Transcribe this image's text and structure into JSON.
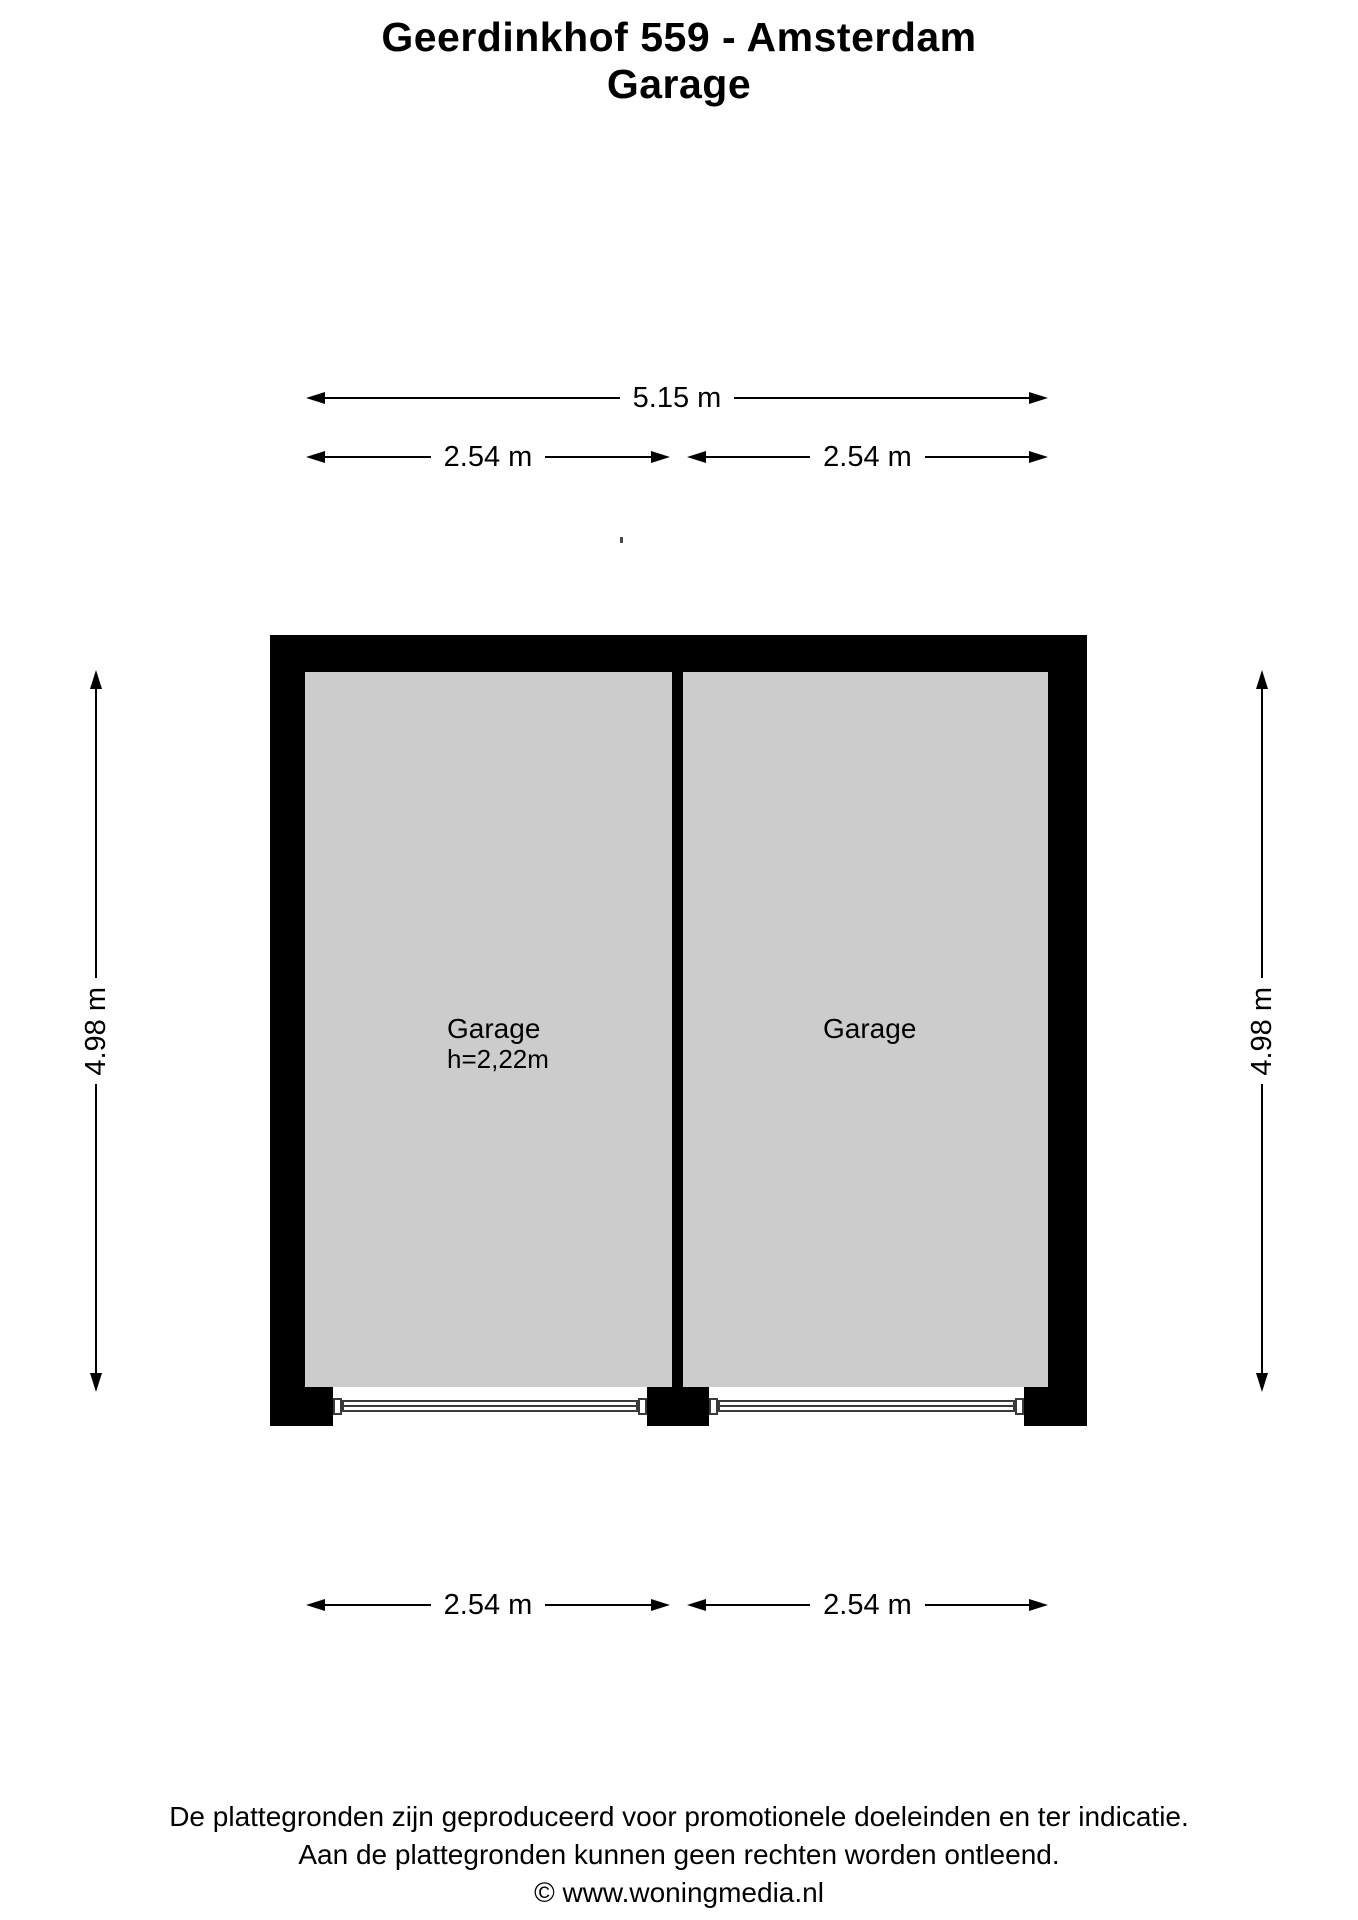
{
  "title": {
    "line1": "Geerdinkhof 559 - Amsterdam",
    "line2": "Garage"
  },
  "dimensions": {
    "top_total": {
      "label": "5.15 m"
    },
    "top_left": {
      "label": "2.54 m"
    },
    "top_right": {
      "label": "2.54 m"
    },
    "side_left": {
      "label": "4.98 m"
    },
    "side_right": {
      "label": "4.98 m"
    },
    "bottom_left": {
      "label": "2.54 m"
    },
    "bottom_right": {
      "label": "2.54 m"
    }
  },
  "floor_plan": {
    "rooms": [
      {
        "name": "Garage",
        "ceiling_height": "h=2,22m"
      },
      {
        "name": "Garage"
      }
    ]
  },
  "colors": {
    "wall": "#000000",
    "room_fill": "#cccccc",
    "door_stroke": "#3a3a3a"
  },
  "footer": {
    "line1": "De plattegronden zijn geproduceerd voor promotionele doeleinden en ter indicatie.",
    "line2": "Aan de plattegronden kunnen geen rechten worden ontleend.",
    "line3": "© www.woningmedia.nl"
  }
}
